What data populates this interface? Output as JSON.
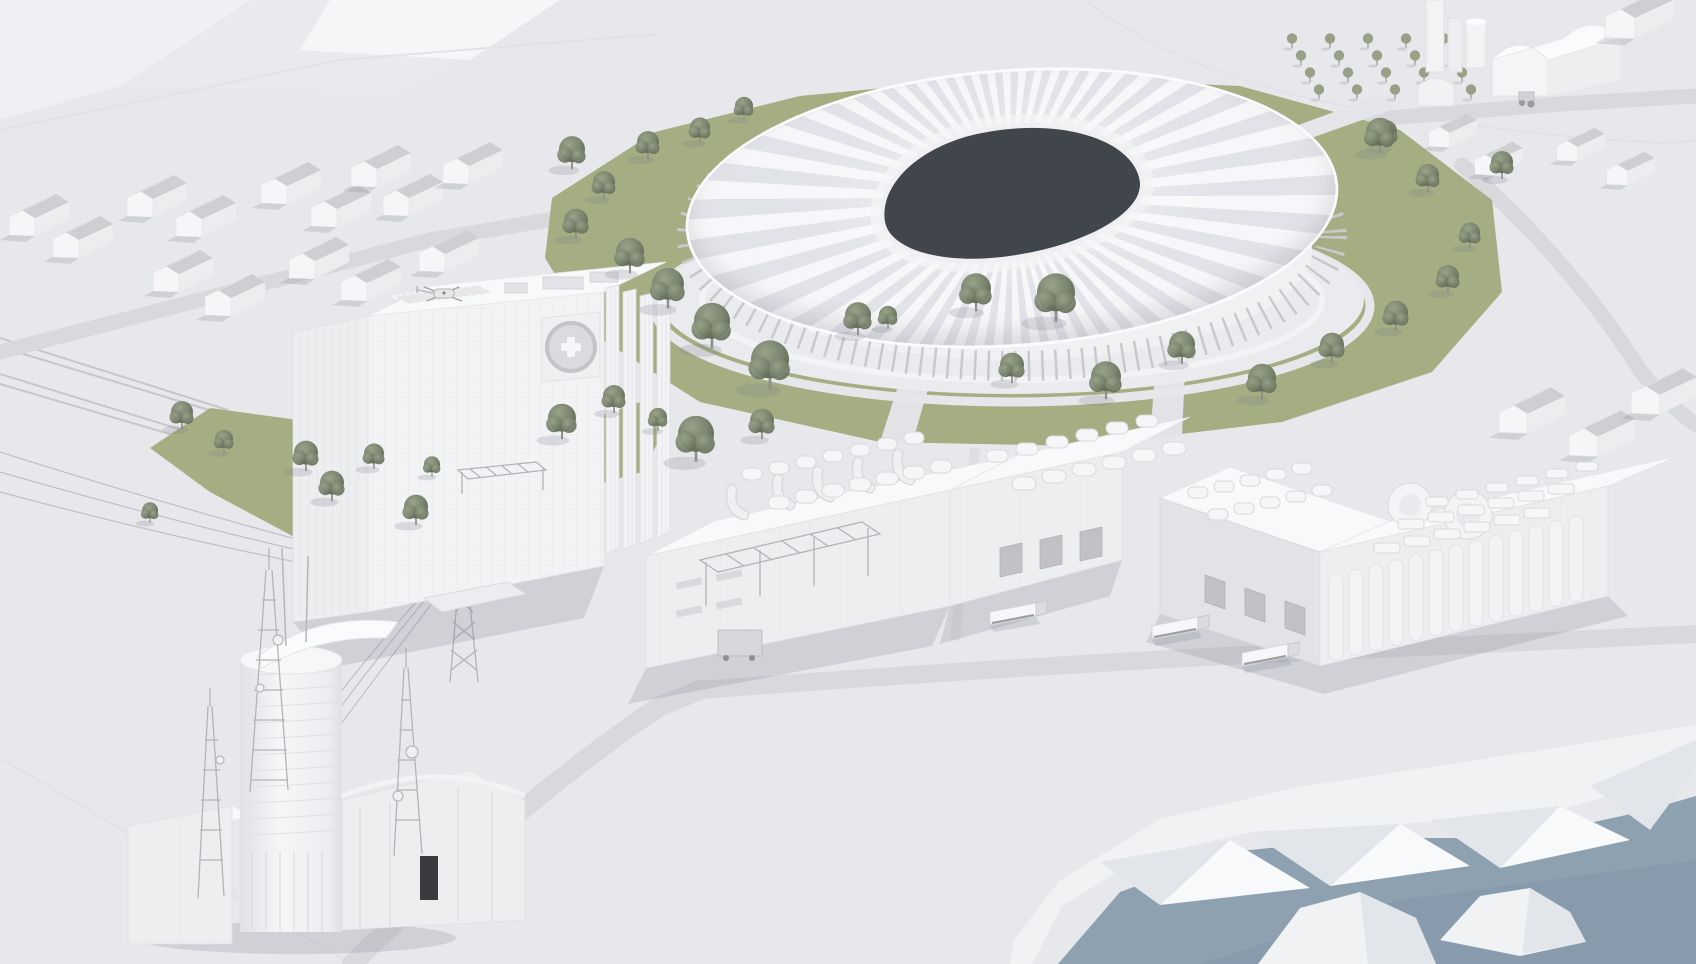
{
  "scene": {
    "labels": {
      "stadium": "stadium-arena",
      "stadium_opening": "stadium-roof-opening",
      "hospital": "hospital-building",
      "helipad": "rooftop-helipad",
      "helicopter": "helicopter",
      "emblem": "medical-cross-emblem",
      "telecom": "telecom-tower-complex",
      "masts": "antenna-masts",
      "pylon": "power-pylon",
      "wires": "power-lines",
      "factory": "factory-complex",
      "silos": "industrial-silos",
      "trucks": "loading-trucks",
      "houses": "residential-houses",
      "farm": "farm-buildings",
      "orchard": "orchard-grid",
      "water": "waterfront",
      "cliffs": "low-poly-cliffs",
      "islets": "rocky-islets",
      "railway": "railway-tracks",
      "roads": "roads",
      "lawn": "green-lawns",
      "trees": "trees"
    }
  },
  "palette": {
    "ground": "#e7e8ec",
    "facet_light": "#eef0f3",
    "facet_bright": "#f5f6f8",
    "ridge": "#e1e2e6",
    "road": "#d8d9dd",
    "rail": "#c6c7cb",
    "wall": "#f2f3f5",
    "wall_mid": "#eceef0",
    "wall_shade": "#e2e3e7",
    "wall_dark": "#d0d1d5",
    "roof": "#f8f9fa",
    "roof_dark": "#cfd0d4",
    "pleat_light": "#f7f7f9",
    "pleat_shade": "#e2e3e8",
    "opening": "#41454c",
    "plinth": "#eaebef",
    "grass": "#a5ae83",
    "tree_light": "#939c82",
    "tree_dark": "#646e57",
    "orchard": "#98a187",
    "water": "#8da1b0",
    "water_deep": "#8398a9",
    "cliff": "#f0f2f4",
    "cliff_shade": "#e2e5e9",
    "cliff_bright": "#f8f9fb",
    "metal": "#b3b4b9",
    "line": "#c8c9cd",
    "door": "#3a3b3f",
    "emblem": "#d9dbdf",
    "wire": "#b9bac0",
    "shadow": "rgba(125,128,140,0.22)"
  }
}
